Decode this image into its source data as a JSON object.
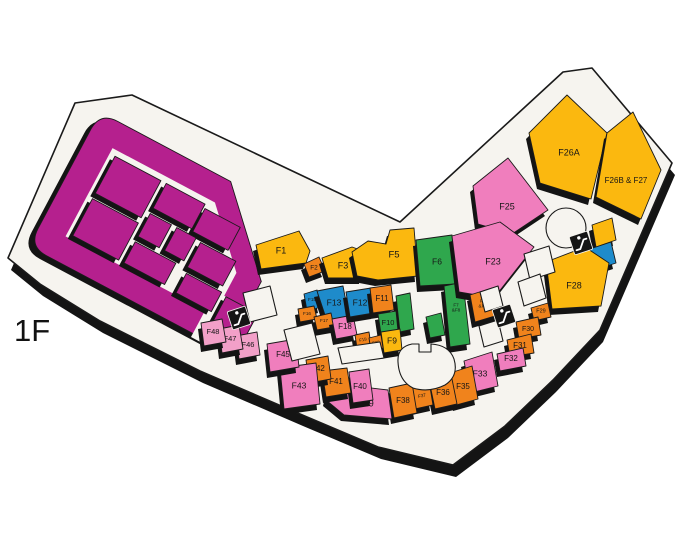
{
  "floor": {
    "label": "1F"
  },
  "palette": {
    "magenta": "#B5208E",
    "pink": "#F07EBD",
    "lightpink": "#F2A0C8",
    "yellow": "#FBB80F",
    "orange": "#F0831C",
    "green": "#2FA74D",
    "blue": "#1E8BCB",
    "floor": "#F6F4EF",
    "line": "#1A1A1A",
    "shadow": "#141414"
  },
  "icons": [
    {
      "name": "escalator-icon"
    },
    {
      "name": "escalator-icon"
    },
    {
      "name": "escalator-icon"
    }
  ],
  "units": [
    {
      "id": "F1",
      "label": "F1",
      "color": "yellow"
    },
    {
      "id": "F2",
      "label": "F2",
      "color": "orange"
    },
    {
      "id": "F3",
      "label": "F3",
      "color": "yellow"
    },
    {
      "id": "F5",
      "label": "F5",
      "color": "yellow"
    },
    {
      "id": "F6",
      "label": "F6",
      "color": "green"
    },
    {
      "id": "F7-F8",
      "label": "F7",
      "label2": "&F8",
      "color": "green"
    },
    {
      "id": "green-block-a",
      "label": "",
      "color": "green"
    },
    {
      "id": "green-block-b",
      "label": "",
      "color": "green"
    },
    {
      "id": "F15",
      "label": "F15",
      "color": "blue"
    },
    {
      "id": "F13",
      "label": "F13",
      "color": "blue"
    },
    {
      "id": "F16",
      "label": "F16",
      "color": "orange"
    },
    {
      "id": "F17",
      "label": "F17",
      "color": "orange"
    },
    {
      "id": "F18",
      "label": "F18",
      "color": "pink"
    },
    {
      "id": "F12",
      "label": "F12",
      "color": "blue"
    },
    {
      "id": "F11",
      "label": "F11",
      "color": "orange"
    },
    {
      "id": "F10",
      "label": "F10",
      "color": "green"
    },
    {
      "id": "F9",
      "label": "F9",
      "color": "yellow"
    },
    {
      "id": "F19",
      "label": "F19",
      "color": "orange"
    },
    {
      "id": "F20",
      "label": "F20",
      "color": "orange"
    },
    {
      "id": "F25",
      "label": "F25",
      "color": "pink"
    },
    {
      "id": "F23",
      "label": "F23",
      "color": "pink"
    },
    {
      "id": "F21-F22",
      "label": "F21",
      "label2": "&F22",
      "color": "orange"
    },
    {
      "id": "F26A",
      "label": "F26A",
      "color": "yellow"
    },
    {
      "id": "F26B-F27",
      "label": "F26B & F27",
      "color": "yellow"
    },
    {
      "id": "yellow-connector",
      "label": "",
      "color": "yellow"
    },
    {
      "id": "blue-block",
      "label": "",
      "color": "blue"
    },
    {
      "id": "F28",
      "label": "F28",
      "color": "yellow"
    },
    {
      "id": "F29",
      "label": "F29",
      "color": "orange"
    },
    {
      "id": "F30",
      "label": "F30",
      "color": "orange"
    },
    {
      "id": "F31",
      "label": "F31",
      "color": "orange"
    },
    {
      "id": "F32",
      "label": "F32",
      "color": "pink"
    },
    {
      "id": "F33",
      "label": "F33",
      "color": "pink"
    },
    {
      "id": "F35",
      "label": "F35",
      "color": "orange"
    },
    {
      "id": "F36",
      "label": "F36",
      "color": "orange"
    },
    {
      "id": "F37",
      "label": "F37",
      "color": "orange"
    },
    {
      "id": "F38",
      "label": "F38",
      "color": "orange"
    },
    {
      "id": "F39",
      "label": "F39",
      "color": "pink"
    },
    {
      "id": "F40",
      "label": "F40",
      "color": "pink"
    },
    {
      "id": "F41",
      "label": "F41",
      "color": "orange"
    },
    {
      "id": "F42",
      "label": "F42",
      "color": "orange"
    },
    {
      "id": "F43",
      "label": "F43",
      "color": "pink"
    },
    {
      "id": "F45",
      "label": "F45",
      "color": "pink"
    },
    {
      "id": "F46",
      "label": "F46",
      "color": "lightpink"
    },
    {
      "id": "F47",
      "label": "F47",
      "color": "lightpink"
    },
    {
      "id": "F48",
      "label": "F48",
      "color": "lightpink"
    }
  ]
}
